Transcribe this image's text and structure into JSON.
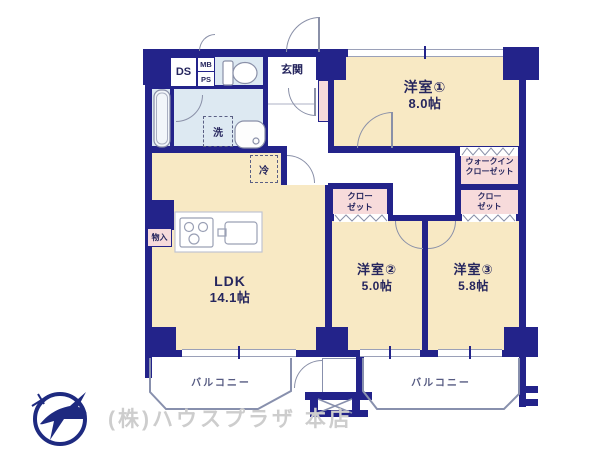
{
  "rooms": {
    "western1": {
      "name": "洋室①",
      "size": "8.0帖"
    },
    "western2": {
      "name": "洋室②",
      "size": "5.0帖"
    },
    "western3": {
      "name": "洋室③",
      "size": "5.8帖"
    },
    "ldk": {
      "name": "LDK",
      "size": "14.1帖"
    },
    "entrance": {
      "name": "玄関"
    },
    "walk_in_closet": {
      "line1": "ウォークイン",
      "line2": "クローゼット"
    },
    "closet_mid": {
      "line1": "クロー",
      "line2": "ゼット"
    },
    "closet_right": {
      "line1": "クロー",
      "line2": "ゼット"
    },
    "balcony_left": {
      "name": "バルコニー"
    },
    "balcony_right": {
      "name": "バルコニー"
    }
  },
  "fixtures": {
    "duct": "DS",
    "meter_box": "MB",
    "pipe_space": "PS",
    "laundry": "洗",
    "refrigerator": "冷",
    "storage": "物入"
  },
  "footer": {
    "company": "(株)ハウスプラザ 本店"
  },
  "colors": {
    "wall": "#23238a",
    "room": "#f8e9c4",
    "wet_area": "#dde9f2",
    "closet": "#f7dbdb"
  }
}
